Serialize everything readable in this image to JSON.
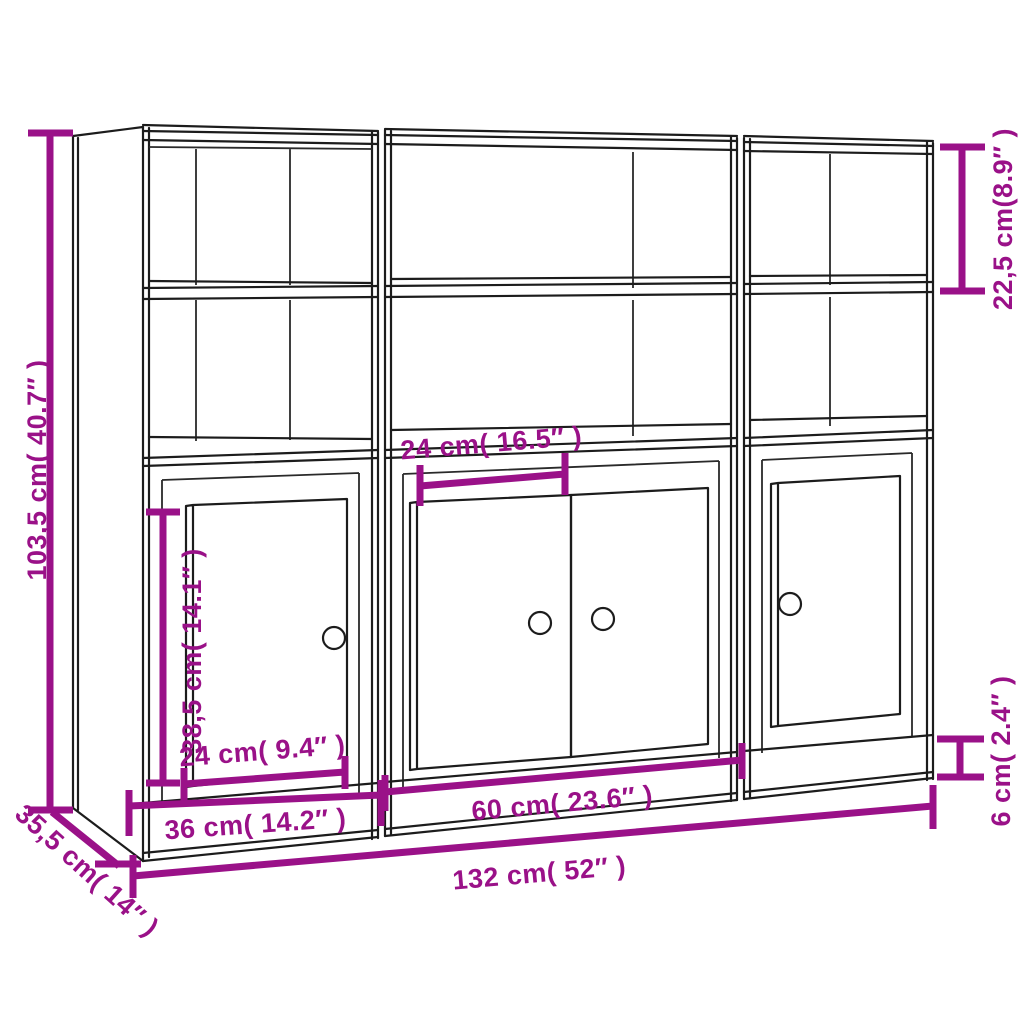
{
  "diagram": {
    "subject": "three-unit highboard bookcase with open shelves, lower doors and plinth — product dimension drawing",
    "units_shown": 3,
    "colors": {
      "dimension_accent": "#9a1188",
      "outline": "#1c1c1c",
      "background": "#ffffff"
    },
    "dimensions": {
      "total_height": "103,5 cm( 40.7″ )",
      "top_compartment_height": "22,5 cm(8.9″ )",
      "door_height": "38,5 cm( 14.1″ )",
      "left_door_width": "24 cm( 9.4″ )",
      "middle_compartment_width": "24 cm( 16.5″ )",
      "left_unit_width": "36 cm( 14.2″ )",
      "middle_unit_width": "60 cm( 23.6″ )",
      "total_width": "132 cm( 52″ )",
      "depth": "35,5 cm( 14″ )",
      "plinth_height": "6 cm( 2.4″ )"
    }
  }
}
